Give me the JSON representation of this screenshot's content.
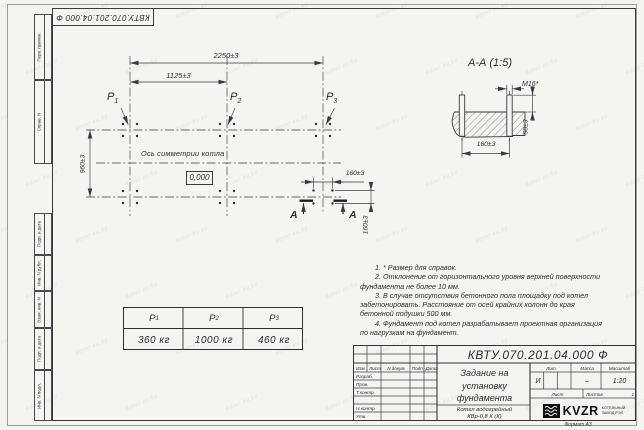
{
  "corner_stamp": "КВТУ.070.201.04.000 Ф",
  "margin": {
    "top": [
      "Перв. примен.",
      "Справ. N"
    ],
    "bottom": [
      "Подп. и дата",
      "Инв. N дубл.",
      "Взам. инв. N",
      "Подп. и дата",
      "Инв. N подл."
    ]
  },
  "plan": {
    "dim_overall": "2250±3",
    "dim_half": "1125±3",
    "dim_depth": "960±3",
    "dim_bolt_x": "160±3",
    "dim_bolt_y": "160±3",
    "labels": [
      {
        "base": "P",
        "sub": "1"
      },
      {
        "base": "P",
        "sub": "2"
      },
      {
        "base": "P",
        "sub": "3"
      }
    ],
    "axis_label": "Ось симметрии котла",
    "elevation": "0,000",
    "section_letter": "А"
  },
  "section": {
    "title": "А-А (1:5)",
    "thread": "М16*",
    "dim_height": "50±3",
    "dim_spacing": "160±3"
  },
  "loads_table": {
    "headers": [
      {
        "base": "P",
        "sub": "1"
      },
      {
        "base": "P",
        "sub": "2"
      },
      {
        "base": "P",
        "sub": "3"
      }
    ],
    "values": [
      "360 кг",
      "1000 кг",
      "460 кг"
    ]
  },
  "notes": {
    "items": [
      "1. * Размер для справок.",
      "2. Отклонение от горизонтального уровня верхней поверхности фундамента не более 10 мм.",
      "3. В случае отсутствия бетонного пола площадку под котел забетонировать. Расстояние от осей крайних колонн до края бетонной подушки 500 мм.",
      "4. Фундамент под котел разрабатывает проектная организация по нагрузкам на фундамент."
    ]
  },
  "title_block": {
    "doc_number": "КВТУ.070.201.04.000 Ф",
    "title_lines": [
      "Задание на",
      "установку",
      "фундамента"
    ],
    "product_lines": [
      "Котел водогрейный",
      "КВр-0,8 К (К)"
    ],
    "header_cols": [
      "Изм.",
      "Лист",
      "N докум.",
      "Подп.",
      "Дата"
    ],
    "sig_rows": [
      "Разраб.",
      "Пров.",
      "Т.контр.",
      "",
      "Н.контр.",
      "Утв."
    ],
    "lit_label": "Лит.",
    "lit_value": "И",
    "mass_label": "Масса",
    "mass_value": "–",
    "scale_label": "Масштаб",
    "scale_value": "1:20",
    "sheet_label": "Лист",
    "sheets_label": "Листов",
    "sheets_value": "1",
    "company": {
      "name": "KVZR",
      "line1": "КОТЕЛЬНЫЙ",
      "line2": "ЗАВОД РЭП"
    },
    "format_label": "Формат А3"
  },
  "watermark": {
    "text": "kotel-kv.kz"
  },
  "colors": {
    "line": "#3a3a3a",
    "paper": "#f4f4f1",
    "watermark": "#64816d"
  }
}
